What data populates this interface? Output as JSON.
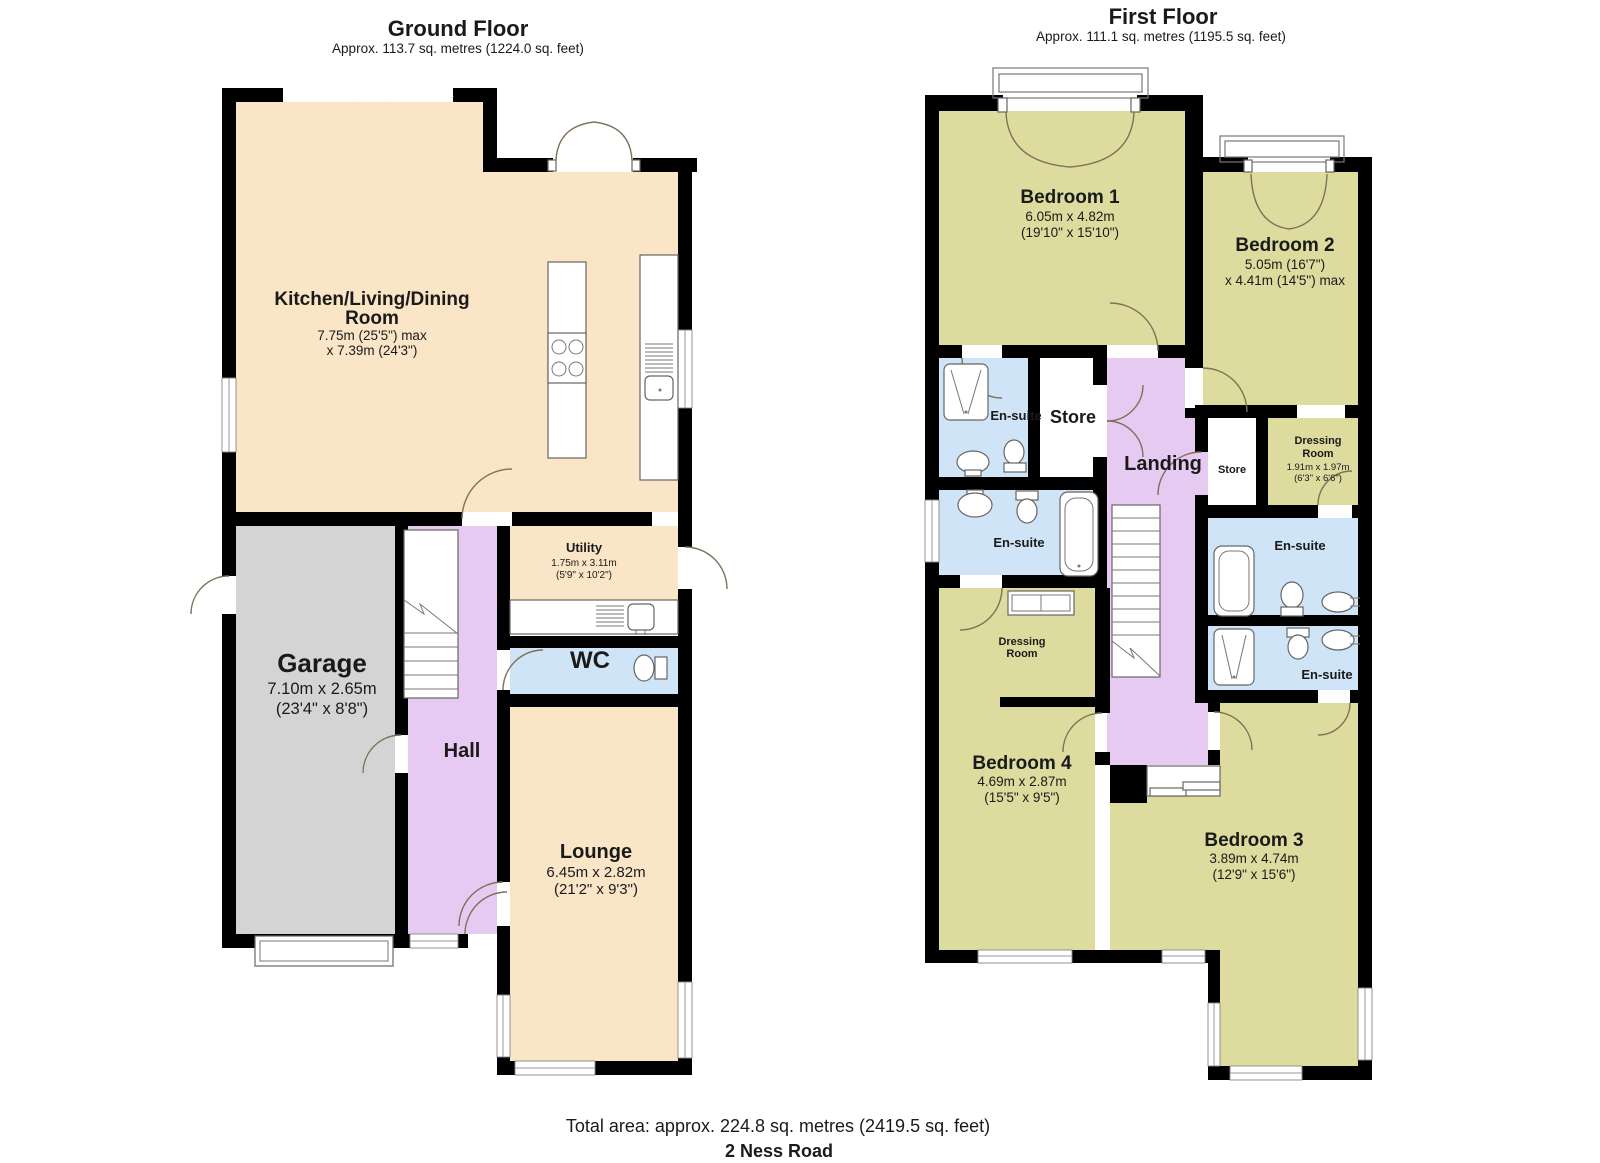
{
  "palette": {
    "cream": "#fae5c7",
    "olive": "#dddc9e",
    "purple": "#e7caf2",
    "blue": "#cfe4f7",
    "gray": "#d4d4d4",
    "wall": "#000000",
    "white": "#ffffff"
  },
  "ground_floor": {
    "title": "Ground Floor",
    "subtitle": "Approx. 113.7 sq. metres (1224.0 sq. feet)",
    "rooms": {
      "kitchen": {
        "line1": "Kitchen/Living/Dining",
        "line2": "Room",
        "dim1": "7.75m (25'5\") max",
        "dim2": "x 7.39m (24'3\")"
      },
      "garage": {
        "name": "Garage",
        "dim1": "7.10m x 2.65m",
        "dim2": "(23'4\" x 8'8\")"
      },
      "hall": {
        "name": "Hall"
      },
      "utility": {
        "name": "Utility",
        "dim1": "1.75m x 3.11m",
        "dim2": "(5'9\" x 10'2\")"
      },
      "wc": {
        "name": "WC"
      },
      "lounge": {
        "name": "Lounge",
        "dim1": "6.45m x 2.82m",
        "dim2": "(21'2\" x 9'3\")"
      }
    }
  },
  "first_floor": {
    "title": "First Floor",
    "subtitle": "Approx. 111.1 sq. metres (1195.5 sq. feet)",
    "rooms": {
      "bedroom1": {
        "name": "Bedroom 1",
        "dim1": "6.05m x 4.82m",
        "dim2": "(19'10\" x 15'10\")"
      },
      "bedroom2": {
        "name": "Bedroom 2",
        "dim1": "5.05m (16'7\")",
        "dim2": "x 4.41m (14'5\") max"
      },
      "ensuite_bedroom1": {
        "name": "En-suite"
      },
      "store_landing": {
        "name": "Store"
      },
      "landing": {
        "name": "Landing"
      },
      "store_small": {
        "name": "Store"
      },
      "dressing_room_b2": {
        "line1": "Dressing",
        "line2": "Room",
        "dim1": "1.91m x 1.97m",
        "dim2": "(6'3\" x 6'6\")"
      },
      "ensuite_left": {
        "name": "En-suite"
      },
      "ensuite_right_upper": {
        "name": "En-suite"
      },
      "ensuite_right_lower": {
        "name": "En-suite"
      },
      "dressing_room_b4": {
        "line1": "Dressing",
        "line2": "Room"
      },
      "bedroom4": {
        "name": "Bedroom 4",
        "dim1": "4.69m x 2.87m",
        "dim2": "(15'5\" x 9'5\")"
      },
      "bedroom3": {
        "name": "Bedroom 3",
        "dim1": "3.89m x 4.74m",
        "dim2": "(12'9\" x 15'6\")"
      }
    }
  },
  "footer": {
    "total_area": "Total area: approx. 224.8 sq. metres (2419.5 sq. feet)",
    "address": "2 Ness Road"
  }
}
